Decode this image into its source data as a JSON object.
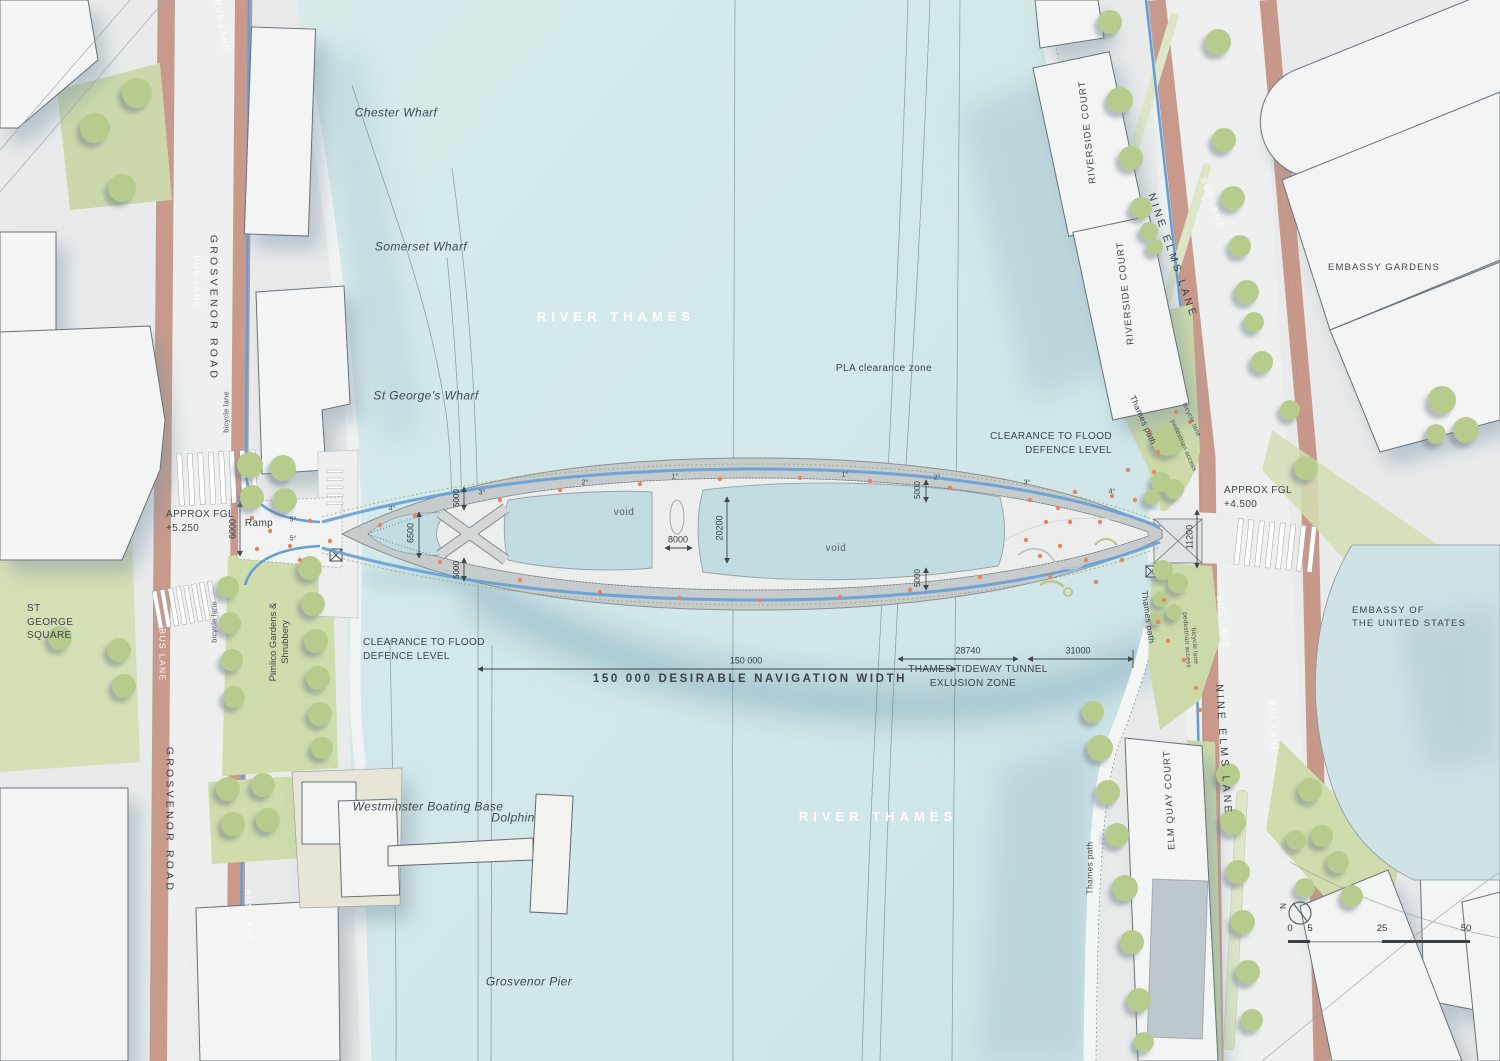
{
  "river": {
    "name": "RIVER THAMES",
    "pla": "PLA clearance zone",
    "wharfs": [
      "Chester Wharf",
      "Somerset Wharf",
      "St George's Wharf"
    ],
    "features": {
      "boating_base": "Westminster Boating Base",
      "dolphin": "Dolphin",
      "pier": "Grosvenor Pier"
    }
  },
  "roads": {
    "grosvenor": "GROSVENOR ROAD",
    "nine_elms": "NINE ELMS LANE",
    "bus_lane": "BUS LANE",
    "bicycle_lane": "bicycle lane",
    "thames_path": "Thames path",
    "pedestrian_access": "pedestrian access",
    "ramp": "Ramp"
  },
  "places": {
    "st_george_l1": "ST",
    "st_george_l2": "GEORGE",
    "st_george_l3": "SQUARE",
    "pimlico_l1": "Pimlico Gardens &",
    "pimlico_l2": "Shrubbery",
    "riverside_court": "RIVERSIDE COURT",
    "embassy_gardens": "EMBASSY GARDENS",
    "embassy_us_l1": "EMBASSY OF",
    "embassy_us_l2": "THE UNITED STATES",
    "elm_quay": "ELM QUAY COURT"
  },
  "annotations": {
    "clearance_l1": "CLEARANCE TO FLOOD",
    "clearance_l2": "DEFENCE LEVEL",
    "fgl_label": "APPROX FGL",
    "fgl_left_value": "+5.250",
    "fgl_right_value": "+4.500",
    "nav_value": "150 000",
    "nav_label": "150 000 DESIRABLE NAVIGATION WIDTH",
    "tideway_l1": "THAMES TIDEWAY TUNNEL",
    "tideway_l2": "EXLUSION ZONE",
    "void": "void"
  },
  "dims": {
    "d6000": "6000",
    "d6500": "6500",
    "d8000": "8000",
    "d20200": "20200",
    "d11200": "11200",
    "d5000": "5000",
    "d28740": "28740",
    "d31000": "31000",
    "g1": "1°",
    "g2": "2°",
    "g3": "3°",
    "g4": "4°",
    "g5": "5°"
  },
  "scalebar": {
    "t0": "0",
    "t5": "5",
    "t25": "25",
    "t50": "50",
    "north": "N"
  },
  "colors": {
    "river": "#d2e7e9",
    "bus_lane": "#c4907f",
    "green": "#cfdcab",
    "tree": "#b7cb8d",
    "cycle_lane": "#64a0d6",
    "people": "#e8835f",
    "bridge_deck": "#c6cbcc"
  }
}
